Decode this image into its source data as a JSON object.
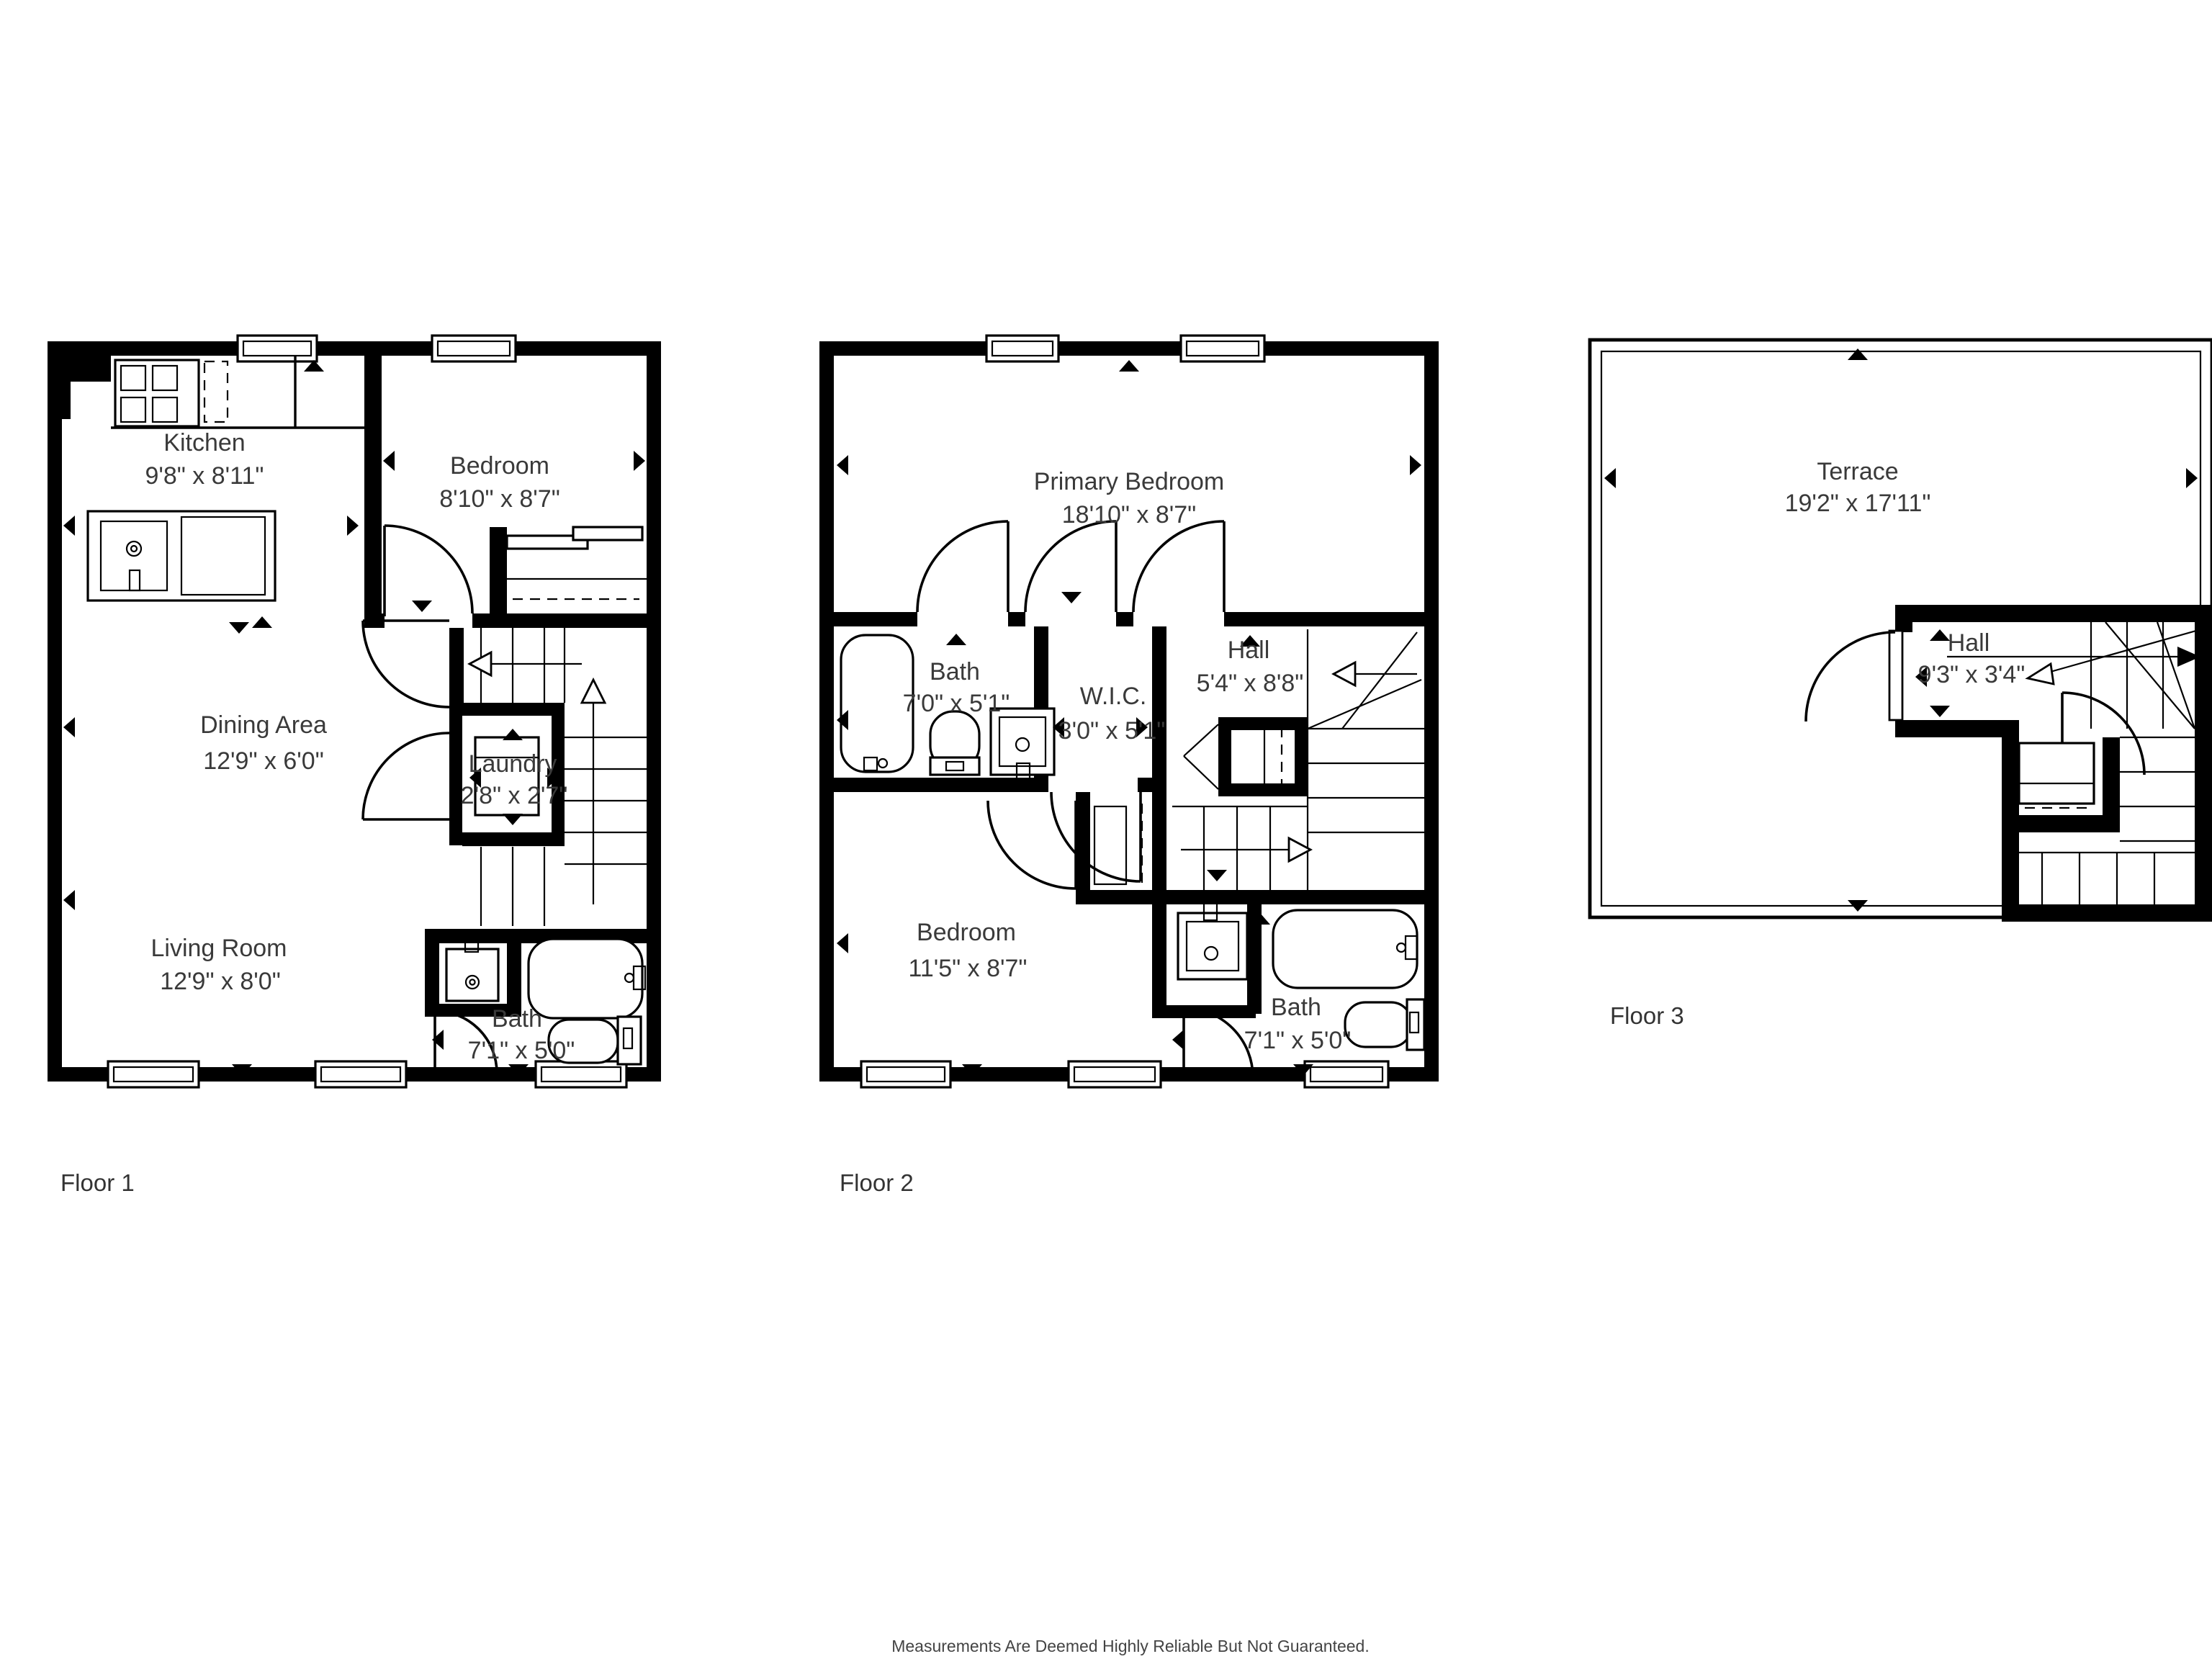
{
  "floors": [
    {
      "label": "Floor 1",
      "rooms": [
        {
          "name": "Kitchen",
          "dims": "9'8\" x 8'11\""
        },
        {
          "name": "Bedroom",
          "dims": "8'10\" x 8'7\""
        },
        {
          "name": "Dining Area",
          "dims": "12'9\" x 6'0\""
        },
        {
          "name": "Laundry",
          "dims": "2'8\" x 2'7\""
        },
        {
          "name": "Living Room",
          "dims": "12'9\" x 8'0\""
        },
        {
          "name": "Bath",
          "dims": "7'1\" x 5'0\""
        }
      ]
    },
    {
      "label": "Floor 2",
      "rooms": [
        {
          "name": "Primary Bedroom",
          "dims": "18'10\" x 8'7\""
        },
        {
          "name": "Bath",
          "dims": "7'0\" x 5'1\""
        },
        {
          "name": "W.I.C.",
          "dims": "3'0\" x 5'1\""
        },
        {
          "name": "Hall",
          "dims": "5'4\" x 8'8\""
        },
        {
          "name": "Bedroom",
          "dims": "11'5\" x 8'7\""
        },
        {
          "name": "Bath",
          "dims": "7'1\" x 5'0\""
        }
      ]
    },
    {
      "label": "Floor 3",
      "rooms": [
        {
          "name": "Terrace",
          "dims": "19'2\" x 17'11\""
        },
        {
          "name": "Hall",
          "dims": "9'3\" x 3'4\""
        }
      ]
    }
  ],
  "disclaimer": "Measurements Are Deemed Highly Reliable But Not Guaranteed.",
  "colors": {
    "wall": "#000000",
    "text": "#3a3a3a",
    "background": "#ffffff"
  }
}
